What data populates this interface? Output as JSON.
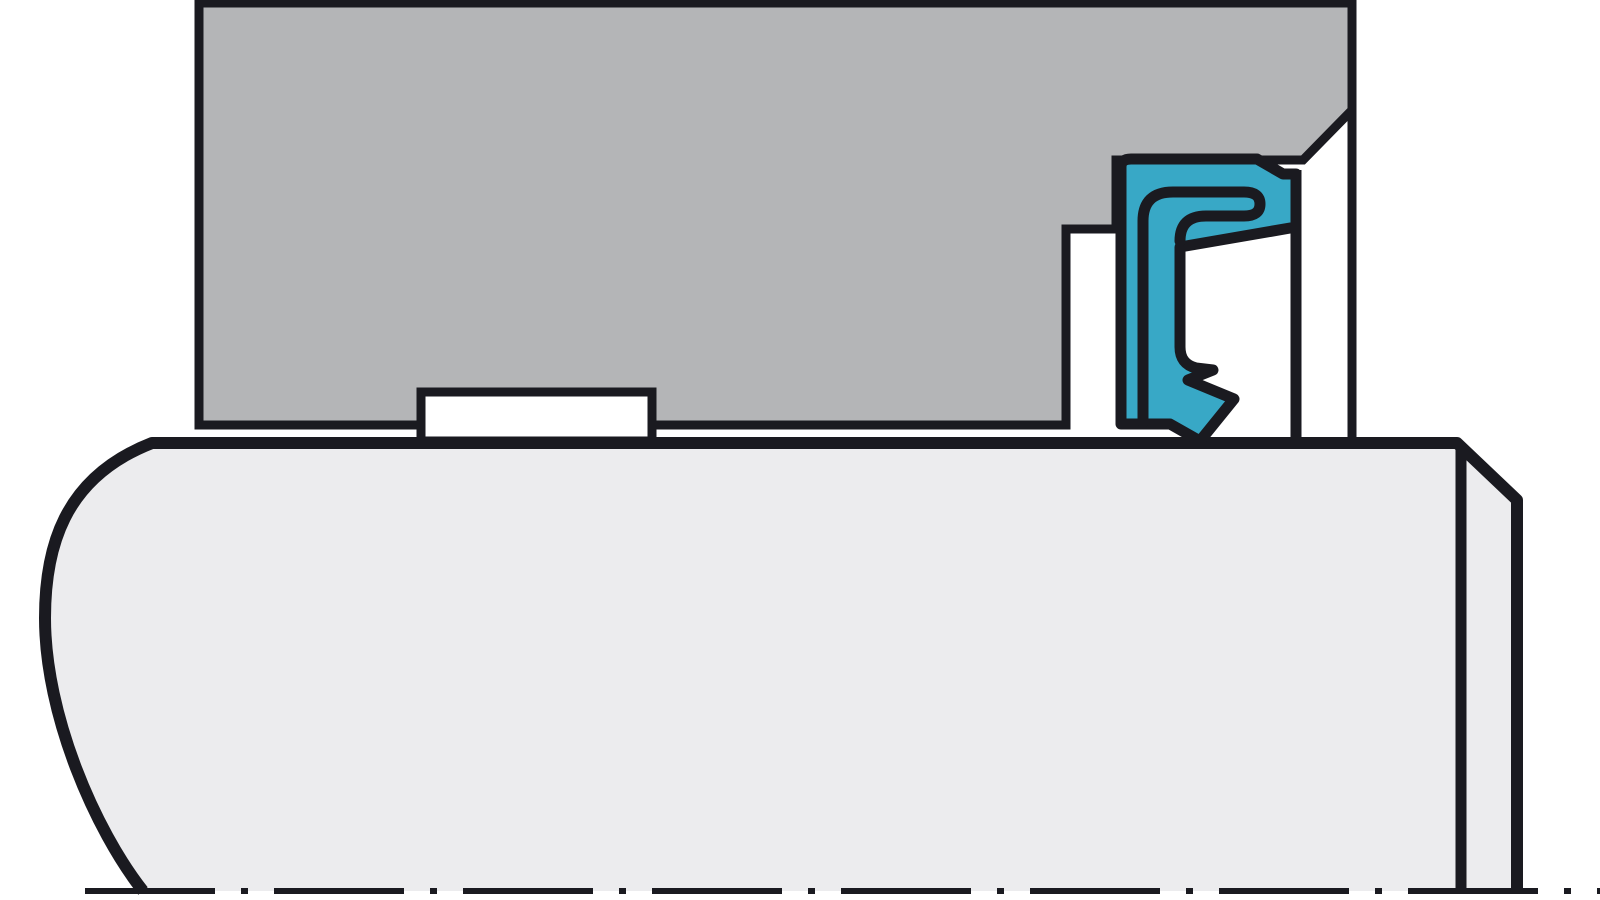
{
  "canvas": {
    "width": 1600,
    "height": 900
  },
  "palette": {
    "housing_gray": "#b4b5b7",
    "shaft_gray": "#ececee",
    "seal_teal": "#38a8c6",
    "line_black": "#1a1a20",
    "background_white": "#ffffff"
  },
  "figure": {
    "kind": "technical-cross-section",
    "subject": "radial shaft seal installed in housing bore over shaft",
    "parts": {
      "housing_body": {
        "name": "housing-cross-section",
        "d": "M 199,3 L 1352,3 L 1352,110 L 1303,160 L 1116,160 L 1116,229 L 1066,229 L 1066,425 L 199,425 Z"
      },
      "housing_face_edge": {
        "name": "housing-outer-face-edge-line",
        "d": "M 1352,108 L 1352,437"
      },
      "shaft_fill": {
        "name": "shaft-fill",
        "d": "M 152,443 L 1457,443 L 1517,500 L 1517,891 L 143,891 C 95,830 45,715 45,618 C 45,550 62,478 152,443 Z"
      },
      "shaft_outline": {
        "name": "shaft-outline",
        "d": "M 143,891 C 95,830 45,715 45,618 C 45,550 62,478 152,443 L 1457,443 L 1517,500 L 1517,891"
      },
      "shaft_chamfer_edge": {
        "name": "shaft-chamfer-edge-line",
        "d": "M 1461,447 L 1461,891"
      },
      "housing_groove": {
        "name": "housing-groove-notch",
        "d": "M 421,392 L 652,392 L 652,441 L 421,441 Z"
      },
      "seal_case_edge": {
        "name": "seal-outer-case-edge-line",
        "d": "M 1296,170 L 1296,440"
      },
      "seal_body": {
        "name": "radial-shaft-seal-body",
        "d": "M 1121,424 L 1121,167 Q 1121,159 1131,159 L 1257,159 L 1283,174 L 1296,174 L 1296,227 L 1180,247 L 1180,347 Q 1180,364 1196,368 L 1213,370 L 1188,380 L 1234,399 L 1200,441 L 1170,424 Z"
      },
      "seal_insert": {
        "name": "seal-metal-insert-outline",
        "d": "M 1143,422 L 1143,221 Q 1143,192 1173,192 L 1244,192 Q 1260,192 1260,204 Q 1260,216 1244,216 L 1206,216 Q 1180,216 1180,241"
      },
      "centerline": {
        "name": "shaft-centerline",
        "d": "M 85,891 L 1600,891",
        "dash_pattern": "130 26 7 26"
      }
    }
  }
}
